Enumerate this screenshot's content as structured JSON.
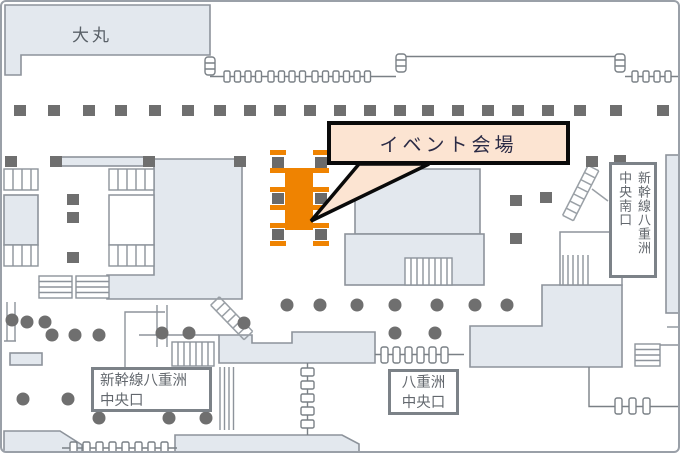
{
  "map": {
    "daimaru_label": "大丸",
    "callout_label": "イベント会場",
    "exits": {
      "south": {
        "line1": "新幹線八重洲",
        "line2": "中央南口"
      },
      "central_shinkansen": {
        "line1": "新幹線八重洲",
        "line2": "中央口"
      },
      "central_yaesu": {
        "line1": "八重洲",
        "line2": "中央口"
      }
    },
    "colors": {
      "highlight_orange": "#ef8301",
      "callout_bg": "#fce4d2",
      "callout_border": "#0a0a0a",
      "block_fill": "#e3e8ee",
      "pillar_gray": "#6f6f6f",
      "outline_gray": "#8d939b"
    }
  }
}
